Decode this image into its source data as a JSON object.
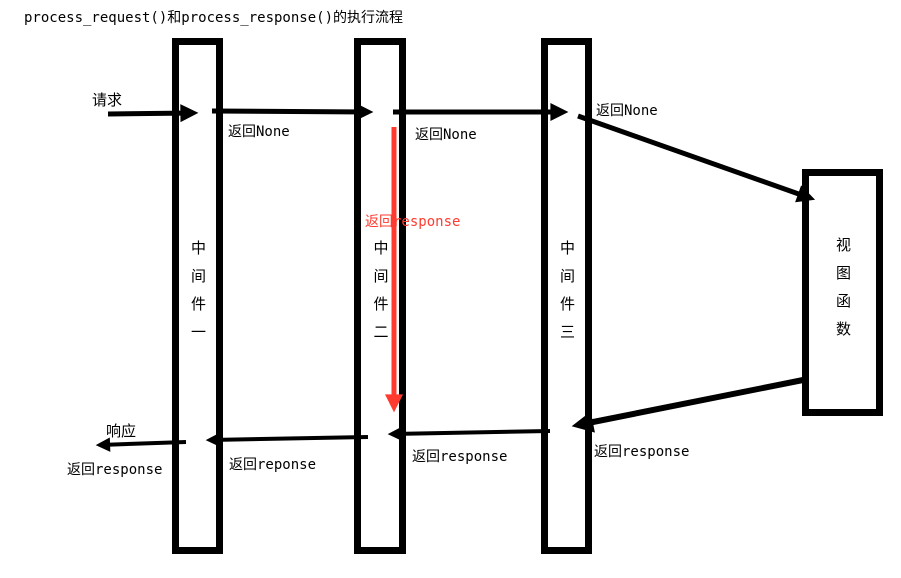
{
  "title": "process_request()和process_response()的执行流程",
  "colors": {
    "arrow_black": "#000000",
    "arrow_red": "#ff3b30"
  },
  "boxes": [
    {
      "label": "中间件一"
    },
    {
      "label": "中间件二"
    },
    {
      "label": "中间件三"
    },
    {
      "label": "视图函数"
    }
  ],
  "labels": {
    "request": "请求",
    "return_none_1": "返回None",
    "return_none_2": "返回None",
    "return_none_3": "返回None",
    "return_response_red": "返回response",
    "response": "响应",
    "return_response_out": "返回response",
    "return_reponse_mw2_mw1": "返回reponse",
    "return_response_mw3_mw2": "返回response",
    "return_response_view_mw3": "返回response"
  }
}
